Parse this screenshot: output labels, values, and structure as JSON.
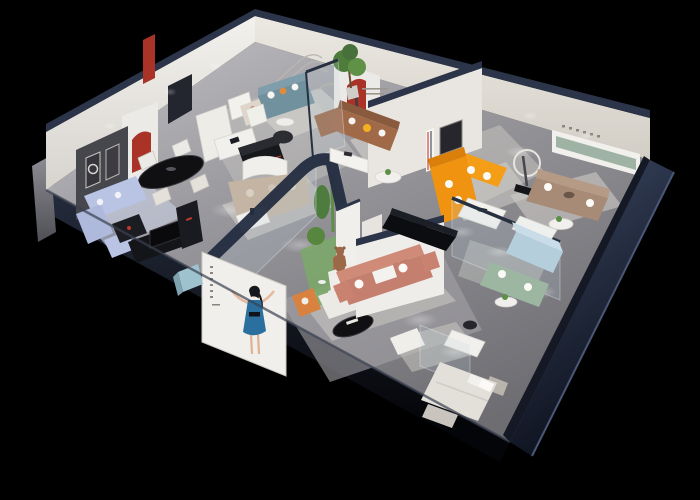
{
  "scene": {
    "type": "3d-isometric-showroom-cutaway-render",
    "background": "#000000",
    "brand": {
      "logo_text": "华悦"
    },
    "palette": {
      "exterior_navy": "#2e3a55",
      "exterior_navy_dark": "#10141f",
      "wall_cap": "#2b3448",
      "interior_wall": "#efede9",
      "interior_wall_shaded": "#ddd9d2",
      "accent_wall_dark": "#46464d",
      "floor_gray": "#97969b",
      "red_accent": "#a93327",
      "logo_red": "#c0271c",
      "logo_black": "#141414",
      "plant_green": "#5d8f46",
      "tree_green": "#4e7c3a",
      "atrium_ground": "#7ba968",
      "sofa_periwinkle": "#b9c4e4",
      "sofa_teal": "#72919f",
      "sofa_brown": "#a06a49",
      "sofa_orange": "#f49d16",
      "sofa_salmon": "#c57f6e",
      "sofa_taupe": "#a78b77",
      "sofa_sage": "#9db6a2",
      "sofa_lightblue": "#b4cedc",
      "sofa_beige": "#c3b4a4",
      "sofa_white": "#eceae5",
      "armchair_orange": "#d9813f",
      "pillow_yellow": "#f5b021",
      "table_black": "#101013",
      "bear_brown": "#9a6a48",
      "bed_white": "#e3e0da",
      "rug_light": "#cfccc6",
      "poster_bg": "#f0efeb",
      "poster_dress_blue": "#2b6f9e",
      "poster_skin": "#e7b99d",
      "green_shelf": "#9eb3a4"
    }
  }
}
